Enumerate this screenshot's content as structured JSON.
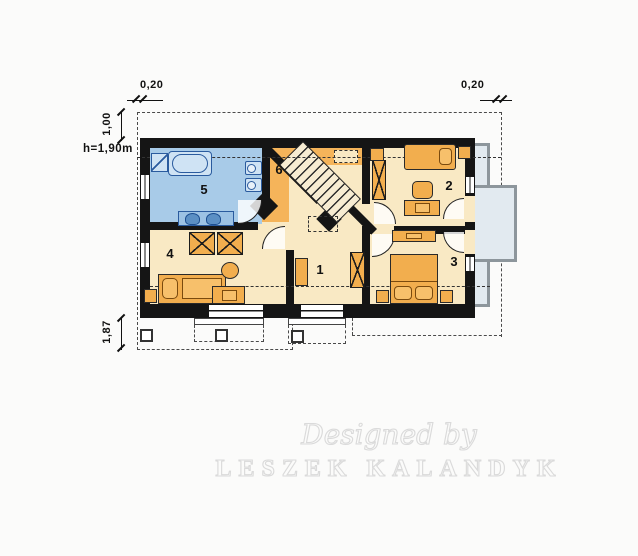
{
  "title": "attic-floor-plan",
  "dims": {
    "top_left": "0,20",
    "top_right": "0,20",
    "left_upper": "1,00",
    "left_lower": "1,87",
    "height_label": "h=1,90m"
  },
  "rooms": [
    {
      "id": "hall",
      "label": "1"
    },
    {
      "id": "bedroom-ne",
      "label": "2"
    },
    {
      "id": "bedroom-se",
      "label": "3"
    },
    {
      "id": "bedroom-sw",
      "label": "4"
    },
    {
      "id": "bathroom",
      "label": "5"
    },
    {
      "id": "landing",
      "label": "6"
    }
  ],
  "watermark": {
    "line1": "Designed by",
    "line2": "LESZEK KALANDYK"
  },
  "colors": {
    "wall": "#151515",
    "room_floor": "#f9e9c4",
    "landing_floor": "#f5b45a",
    "bathroom_floor": "#a8cbe8",
    "furniture": "#f2ae4e",
    "bath_fixture": "#cfe3f4",
    "balcony_slab": "#e2eaf0",
    "railing": "#8d969c",
    "watermark": "#dadada"
  }
}
